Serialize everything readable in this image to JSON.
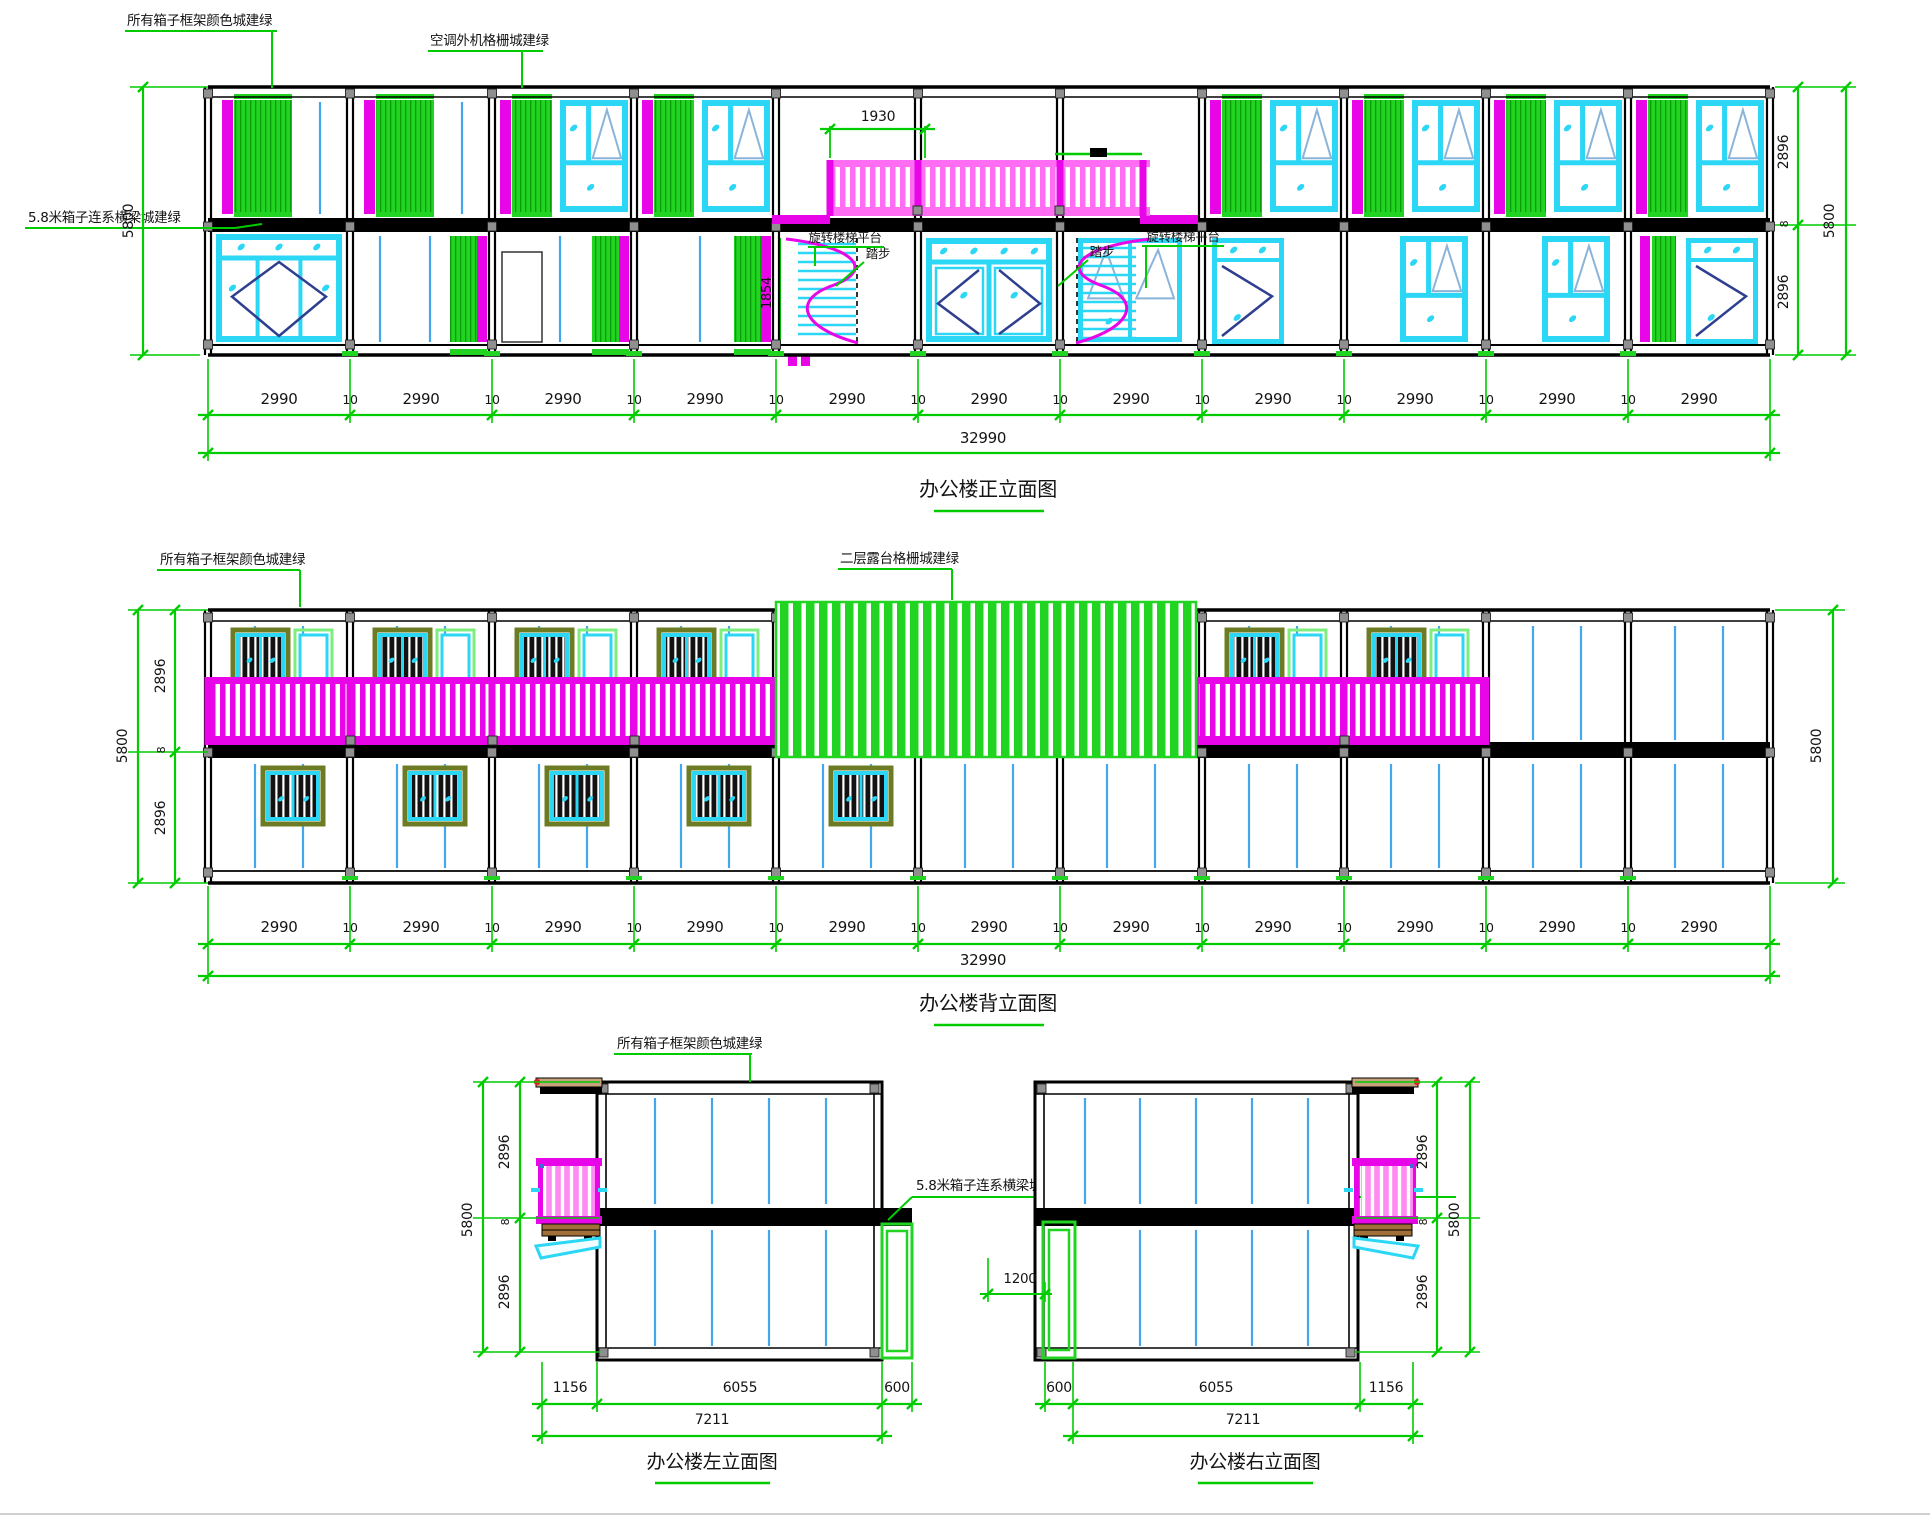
{
  "colors": {
    "annotation_green": "#00cc00",
    "grille_green": "#21d421",
    "grille_dark": "#0b9b0b",
    "magenta": "#e806e8",
    "pink": "#ff6ef2",
    "balcony_pink": "#ff8af2",
    "cyan": "#2bd7f5",
    "pane_blue": "#8ab4d9",
    "line_blue": "#44a7ee",
    "navy": "#2e3f8f",
    "olive": "#6d7c24",
    "ink": "#141414",
    "tan": "#c8a27c",
    "brown": "#a16f38",
    "red": "#e02020",
    "gray": "#8f8f8f"
  },
  "front": {
    "title": "办公楼正立面图",
    "labels": {
      "frame_color": "所有箱子框架颜色城建绿",
      "ac_grille": "空调外机格栅城建绿",
      "tie_beam": "5.8米箱子连系横梁城建绿",
      "stair_platform_left": "旋转楼梯平台",
      "step_left": "踏步",
      "step_right": "踏步",
      "stair_platform_right": "旋转楼梯平台"
    },
    "dims": {
      "bay": "2990",
      "gap": "10",
      "total": "32990",
      "height_left": "5800",
      "upper": "2896",
      "joint": "8",
      "lower": "2896",
      "height_right": "5800",
      "railing": "1930",
      "stair": "1854"
    }
  },
  "back": {
    "title": "办公楼背立面图",
    "labels": {
      "frame_color": "所有箱子框架颜色城建绿",
      "terrace_grille": "二层露台格栅城建绿"
    },
    "dims": {
      "bay": "2990",
      "gap": "10",
      "total": "32990",
      "height_left": "5800",
      "upper": "2896",
      "joint": "8",
      "lower": "2896",
      "height_right": "5800"
    }
  },
  "left": {
    "title": "办公楼左立面图",
    "labels": {
      "frame_color": "所有箱子框架颜色城建绿",
      "tie_beam": "5.8米箱子连系横梁城建绿"
    },
    "dims": {
      "balcony": "1156",
      "body": "6055",
      "porch": "600",
      "total": "7211",
      "height": "5800",
      "upper": "2896",
      "joint": "8",
      "lower": "2896"
    }
  },
  "right": {
    "title": "办公楼右立面图",
    "dims": {
      "porch": "600",
      "body": "6055",
      "balcony": "1156",
      "total": "7211",
      "door": "1200",
      "height": "5800",
      "upper": "2896",
      "joint": "8",
      "lower": "2896"
    }
  }
}
